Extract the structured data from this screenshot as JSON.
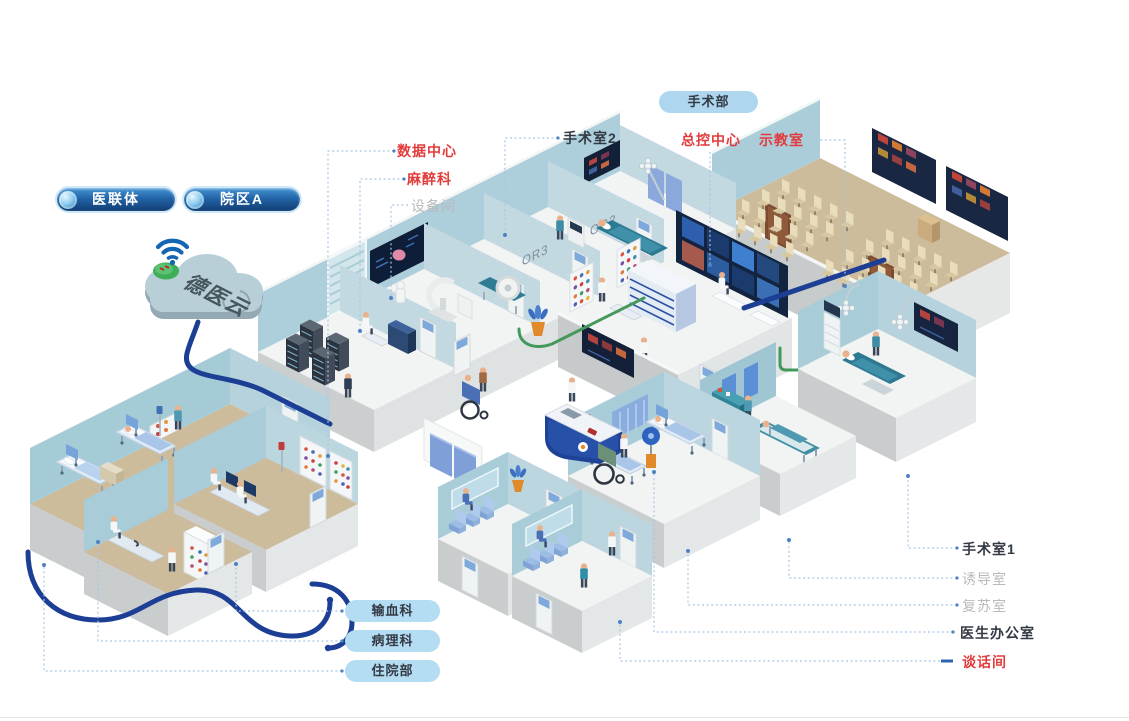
{
  "cloud": {
    "label": "德医云"
  },
  "badges": {
    "alliance": "医联体",
    "campus_a": "院区A",
    "surgery_dept": "手术部"
  },
  "room_labels": {
    "data_center": "数据中心",
    "anesthesiology": "麻醉科",
    "equipment_room": "设备间",
    "operating_room_2": "手术室2",
    "master_control": "总控中心",
    "demo_classroom": "示教室",
    "operating_room_1": "手术室1",
    "induction_room": "诱导室",
    "recovery_room": "复苏室",
    "doctor_office": "医生办公室",
    "talk_room": "谈话间"
  },
  "dept_pills": {
    "blood_transfusion": "输血科",
    "pathology": "病理科",
    "inpatient": "住院部"
  },
  "door_labels": {
    "or2": "OR2",
    "or3": "OR3"
  },
  "colors": {
    "accent_red": "#e23b3b",
    "label_dark": "#333a44",
    "label_gray": "#b8babc",
    "pill_light_bg": "#aed7ef",
    "pill_dark_top": "#4695d3",
    "pill_dark_bottom": "#123d72",
    "cable_blue": "#1c3e94",
    "cable_green": "#43985c",
    "wall_blue": "#aecfda",
    "floor_tan": "#cdbc9c",
    "leader_line": "#a8c6e2"
  }
}
